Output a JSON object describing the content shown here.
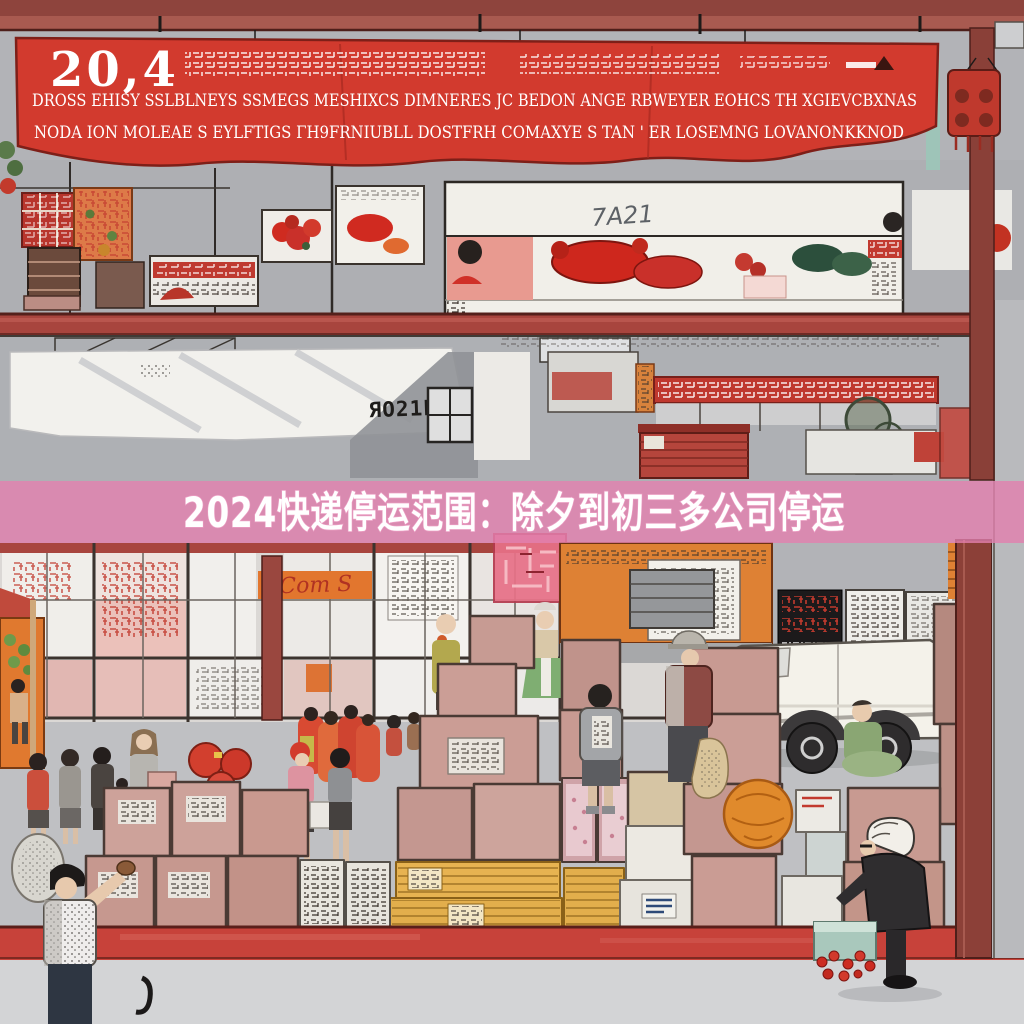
{
  "banner": {
    "year": "20,4",
    "line2": "DROSS EHISY SSLBLNEYS SSMEGS MESHIXCS DIMNERES JC BEDON ANGE RBWEYER EOHCS TH XGIEVCBXNAS",
    "line3": "NODA ION MOLEAE S EYLFTIGS ΓH9FRNIUBLL DOSTFRH COMAXYE S TAN ' ER LOSEMNG LOVANONKKNOD"
  },
  "overlay": {
    "title": "2024快递停运范围：除夕到初三多公司停运",
    "band_color": "#e27fae",
    "text_color": "#ffffff"
  },
  "signs": {
    "wall_stencil": "ЯO21P",
    "counter_handwriting": "7A21",
    "storefront_script": "Com S"
  },
  "colors": {
    "banner_red": "#d23a2e",
    "beam_red": "#a8453e",
    "curb_red": "#c7423a",
    "lantern_red": "#bf392d",
    "crate_yellow": "#e7b351",
    "stall_orange": "#de8134",
    "box_pink": "#c59890",
    "background_gray": "#b2b3b7"
  }
}
